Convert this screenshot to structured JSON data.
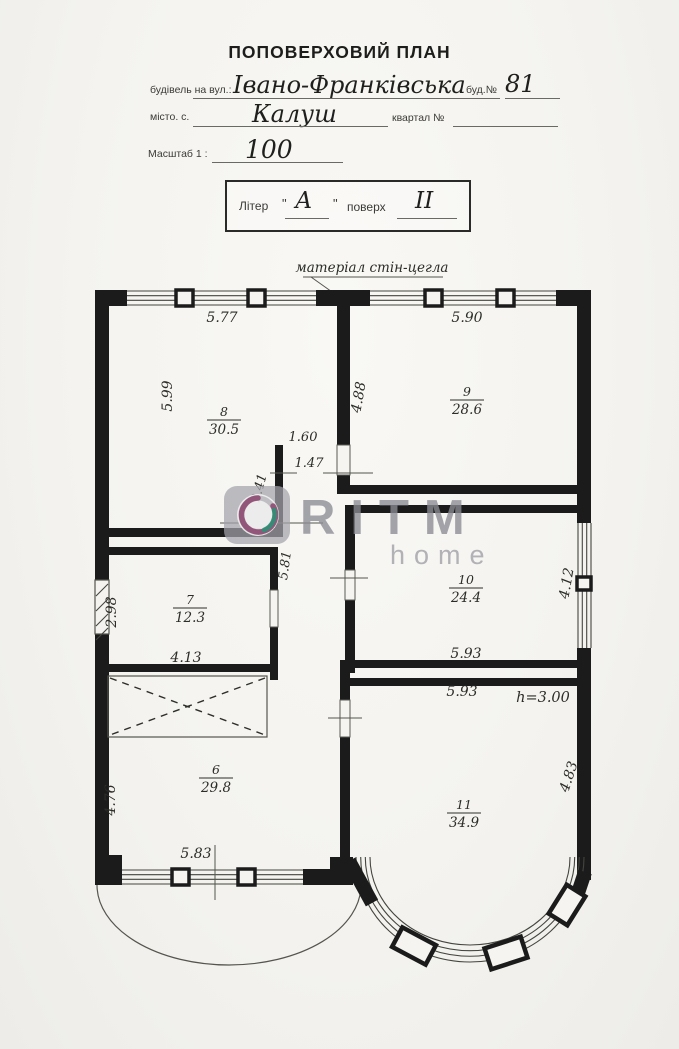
{
  "header": {
    "title": "ПОПОВЕРХОВИЙ ПЛАН"
  },
  "form": {
    "street_label": "будівель на вул.:",
    "street_value": "Івано-Франківська",
    "house_label": "буд.№",
    "house_value": "81",
    "city_label": "місто. с.",
    "city_value": "Калуш",
    "block_label": "квартал №",
    "scale_label": "Масштаб 1 :",
    "scale_value": "100",
    "liter_label": "Літер",
    "quote": "\"",
    "liter_value": "А",
    "floor_label": "поверх",
    "floor_value": "II"
  },
  "plan": {
    "material_note": "матеріал стін-цегла",
    "ceiling_height": "h=3.00",
    "rooms": [
      {
        "number": "6",
        "area": "29.8"
      },
      {
        "number": "7",
        "area": "12.3"
      },
      {
        "number": "8",
        "area": "30.5"
      },
      {
        "number": "9",
        "area": "28.6"
      },
      {
        "number": "10",
        "area": "24.4"
      },
      {
        "number": "11",
        "area": "34.9"
      }
    ],
    "dims": {
      "room8_top": "5.77",
      "room9_top": "5.90",
      "room8_left": "5.99",
      "room9_left": "4.88",
      "passage_upper": "1.60",
      "passage_lower": "1.47",
      "passage_height": "2.41",
      "room7_left": "2.98",
      "room7_bottom": "4.13",
      "corridor_length": "5.81",
      "room10_right": "4.12",
      "room10_bottom": "5.93",
      "room11_top": "5.93",
      "room6_left": "4.76",
      "room6_bottom": "5.83",
      "room11_right": "4.83"
    }
  },
  "watermark": {
    "brand": "RITM",
    "sub": "home",
    "accent_purple": "#8d4a72",
    "accent_teal": "#2f8f74",
    "grey": "#9a9aa2"
  }
}
